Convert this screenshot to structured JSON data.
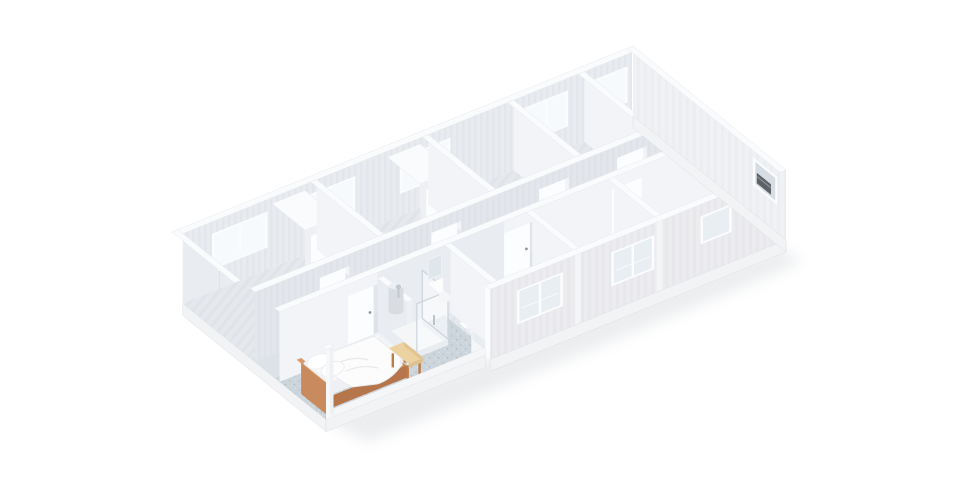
{
  "meta": {
    "view": "isometric-3d-cutaway-render",
    "subject": "modular container building floor plan, roof removed",
    "background": "#ffffff"
  },
  "colors": {
    "background": "#ffffff",
    "wall_top": "#fafbfd",
    "wall_lit": "#f3f4f7",
    "wall_shade": "#e9ecf0",
    "wall_end": "#eef0f4",
    "wall_corridor": "#e3e7ec",
    "wall_back_interior": "#e8ebef",
    "exterior_front": "#ececef",
    "exterior_east": "#f0f1f4",
    "frame": "#fbfcfd",
    "window_glass": "#e9eef2",
    "window_daylight": "#f7fafc",
    "door": "#fcfdfe",
    "door_handle": "#8f979f",
    "floor_rooms": "#e5e8ed",
    "floor_corridor": "#dde2e8",
    "floor_speckle": "#ccd5dc",
    "bed_wood": "#c98b5e",
    "bed_wood_dark": "#b5764b",
    "bedding": "#fbfbfc",
    "bench_wood": "#ecd2a0",
    "bench_leg": "#bf7a45",
    "boiler": "#d9dde2",
    "glass_edge": "#ccd4dc",
    "fixture": "#f4f6f8",
    "mirror": "#dfe7ec",
    "ac_unit": "#5d6166",
    "shadow": "#b9bfc6",
    "plinth": "#f2f3f5"
  },
  "building": {
    "rooms": [
      "furnished bedroom",
      "en-suite bathroom",
      "central corridor",
      "four back bedroom units",
      "two en-suite cubicles",
      "east washroom"
    ],
    "fixtures": [
      "double bed with white duvet and pillows",
      "wooden bench",
      "glass shower cabin",
      "toilet",
      "washbasin with mirror",
      "wall water heater",
      "corner washbasin",
      "window AC unit"
    ],
    "openings": {
      "corridor_doors": 8,
      "back_wall_windows": 5,
      "front_wall_windows": 3,
      "east_wall_windows": 1,
      "entrance": "glazed double door at west end"
    }
  }
}
